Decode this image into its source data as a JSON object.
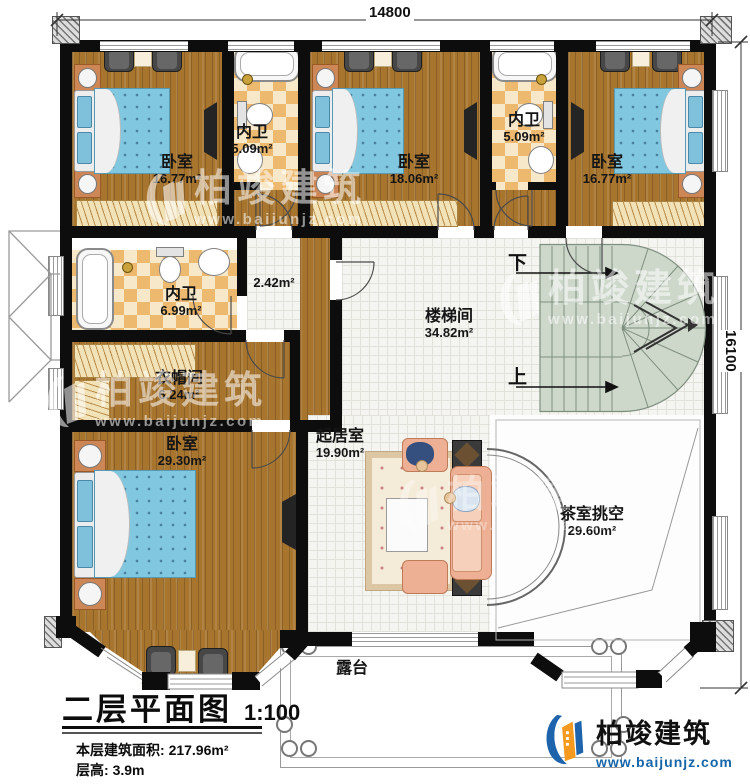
{
  "plan": {
    "title": "二层平面图",
    "scale": "1:100",
    "floor_area_label": "本层建筑面积:",
    "floor_area_value": "217.96m²",
    "floor_height_label": "层高:",
    "floor_height_value": "3.9m"
  },
  "dimensions": {
    "top_width": "14800",
    "right_height": "16100"
  },
  "rooms": {
    "bedroom_top_left": {
      "name": "卧室",
      "area": "16.77m²"
    },
    "bath_top_left": {
      "name": "内卫",
      "area": "5.09m²"
    },
    "bedroom_top_mid": {
      "name": "卧室",
      "area": "18.06m²"
    },
    "bath_top_right": {
      "name": "内卫",
      "area": "5.09m²"
    },
    "bedroom_top_right": {
      "name": "卧室",
      "area": "16.77m²"
    },
    "bath_mid": {
      "name": "内卫",
      "area": "6.99m²"
    },
    "hall": {
      "area": "2.42m²"
    },
    "stairwell": {
      "name": "楼梯间",
      "area": "34.82m²"
    },
    "cloakroom": {
      "name": "衣帽间",
      "area": "6.24m²"
    },
    "bedroom_master": {
      "name": "卧室",
      "area": "29.30m²"
    },
    "living_room": {
      "name": "起居室",
      "area": "19.90m²"
    },
    "tea_room_void": {
      "name": "茶室挑空",
      "area": "29.60m²"
    },
    "terrace": {
      "name": "露台"
    }
  },
  "stairs": {
    "down": "下",
    "up": "上"
  },
  "brand": {
    "name": "柏竣建筑",
    "url": "www.baijunjz.com"
  },
  "colors": {
    "wall": "#0d0d0d",
    "wood": "#a8752f",
    "checker_light": "#f7e8c9",
    "checker_dark": "#edb96e",
    "tile": "#f4f4f1",
    "stair": "#cdd8cb",
    "terrace": "#ece4c4",
    "bed": "#82c7e0",
    "logo_blue": "#1e64ad",
    "logo_orange": "#f59a1e"
  }
}
